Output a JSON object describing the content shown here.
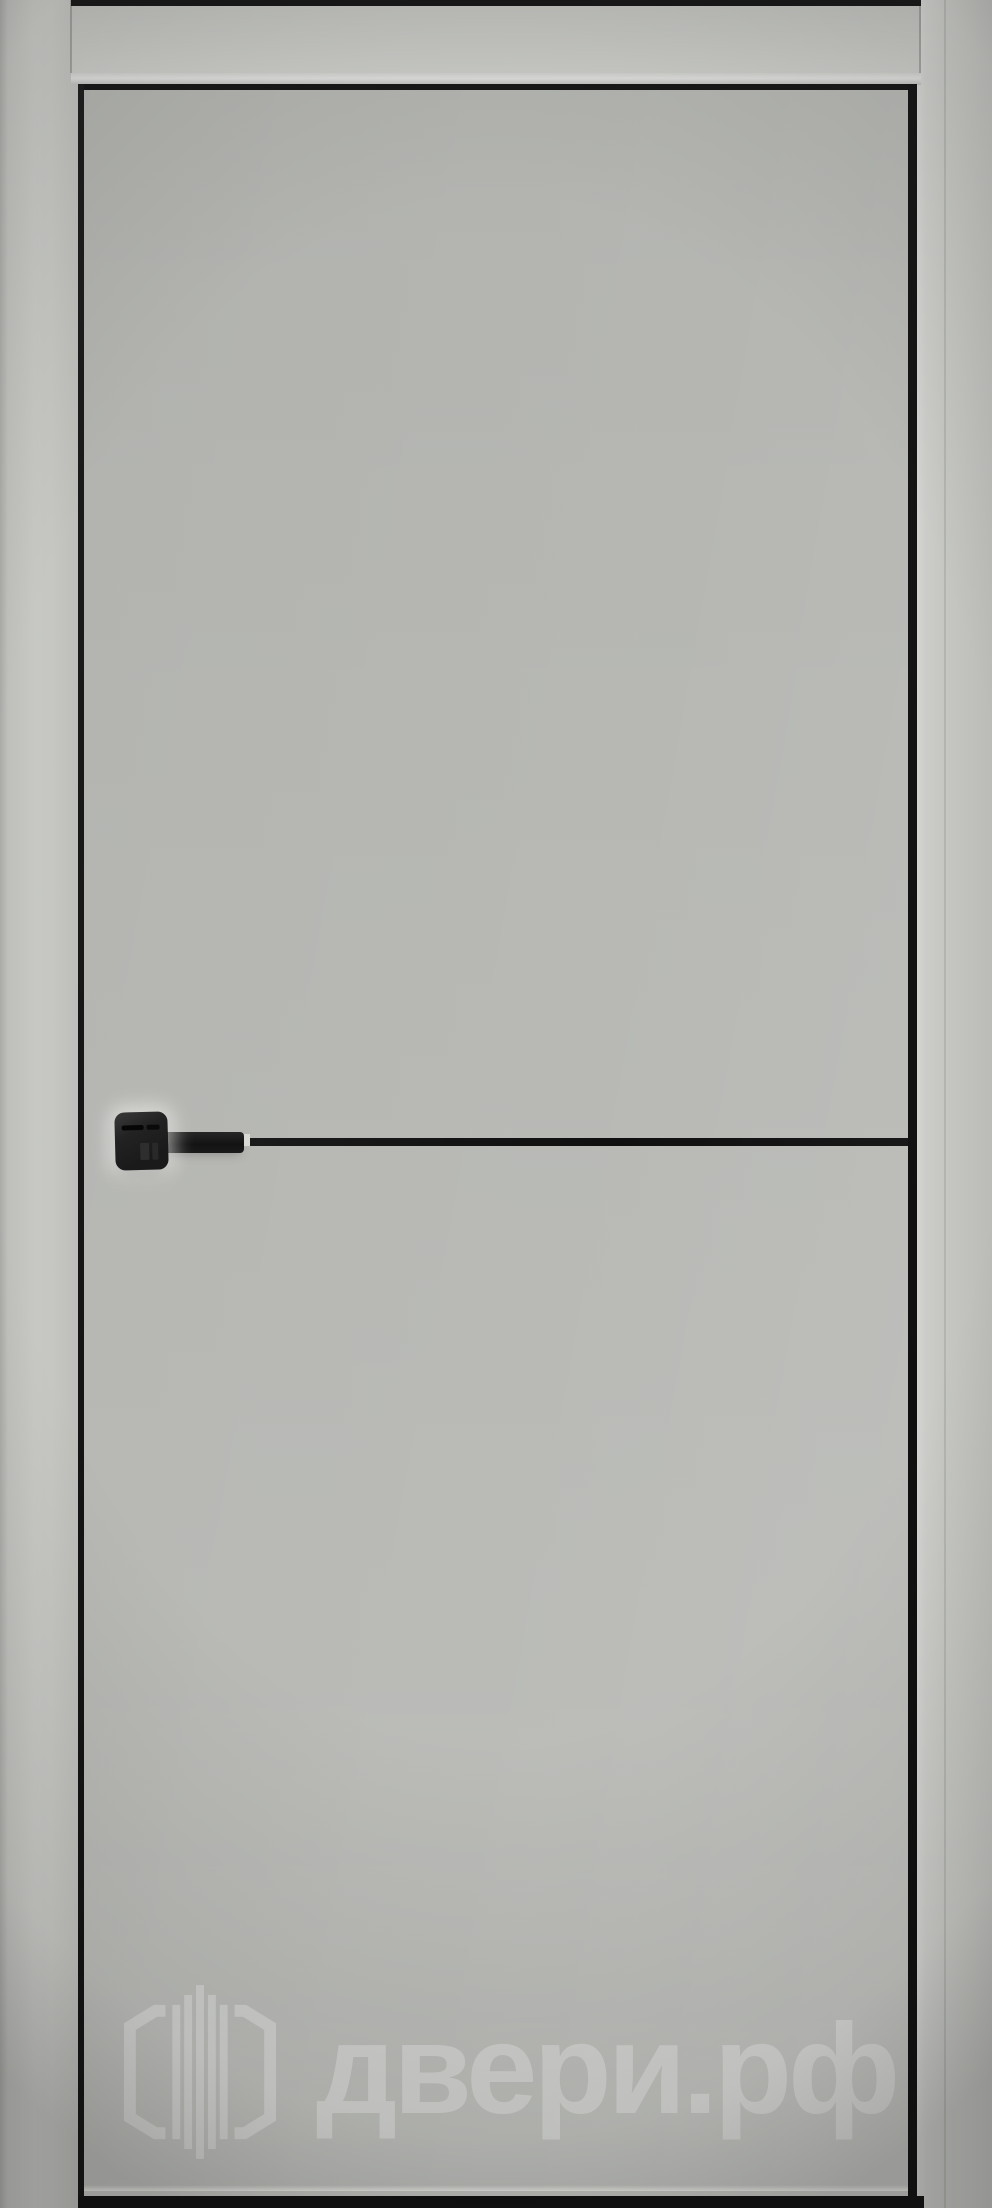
{
  "watermark": {
    "text": "двери.рф",
    "logo": "dveri-rf-hexagon-door-logo"
  },
  "colors": {
    "door_leaf": "#b8b9b5",
    "frame": "#c5c6c2",
    "edge_black": "#171717",
    "handle_black": "#1a1a1a",
    "watermark": "rgba(255,255,255,0.30)"
  }
}
